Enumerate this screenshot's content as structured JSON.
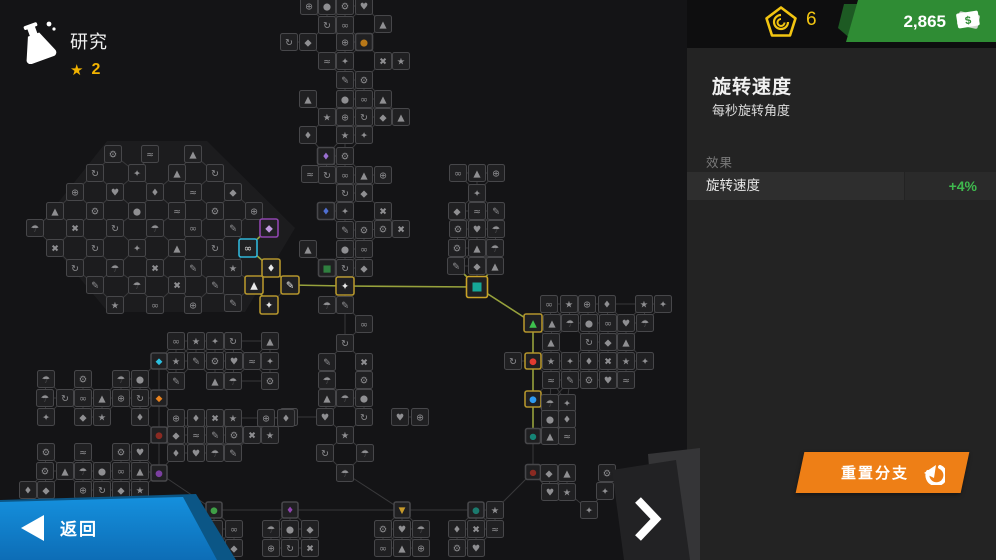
{
  "header": {
    "title": "研究",
    "star_icon": "★",
    "star_count": "2"
  },
  "currency": {
    "research_points": "6",
    "cash": "2,865",
    "cash_symbol": "$"
  },
  "panel": {
    "title": "旋转速度",
    "subtitle": "每秒旋转角度",
    "effects_label": "效果",
    "effect_row": {
      "name": "旋转速度",
      "value": "+4%"
    },
    "reset_label": "重置分支"
  },
  "nav": {
    "back_label": "返回"
  },
  "colors": {
    "accent_orange": "#ee7f16",
    "accent_blue": "#1287d6",
    "badge_green": "#2f8c34",
    "token_yellow": "#f2c511",
    "effect_green": "#3fb94e",
    "active_path": "#97a23c",
    "selected_teal": "#16a797"
  },
  "tree": {
    "plate": [
      [
        38,
        228
      ],
      [
        107,
        141
      ],
      [
        207,
        141
      ],
      [
        295,
        228
      ],
      [
        245,
        312
      ],
      [
        108,
        312
      ]
    ],
    "glyphs": "★♥◆⚙↻✎⊕≈▲✖∞♦●✦☂",
    "variants": {
      "n": {
        "s": 17,
        "b": "#47474a",
        "i": "#8f8f92"
      },
      "yb": {
        "s": 18,
        "b": "#b3942c",
        "i": "#e9e9e9"
      },
      "pb": {
        "s": 18,
        "b": "#8e44ad",
        "i": "#c09ae0"
      },
      "cb": {
        "s": 18,
        "b": "#2fb5d8",
        "i": "#e9e9e9"
      },
      "sel": {
        "s": 21,
        "b": "#c9a227",
        "i": "#16a797",
        "fill": true
      },
      "tri": {
        "s": 18,
        "b": "#b3942c",
        "i": "#3ec14e",
        "g": "▲"
      },
      "red": {
        "s": 16,
        "b": "#b3942c",
        "i": "#e23b30",
        "g": "●"
      },
      "blue": {
        "s": 16,
        "b": "#b3942c",
        "i": "#2f9bf0",
        "g": "●"
      },
      "teal2": {
        "s": 15,
        "b": "#47474a",
        "i": "#158576",
        "g": "●"
      },
      "dred": {
        "s": 15,
        "b": "#47474a",
        "i": "#8a2a22",
        "g": "●"
      },
      "cyan": {
        "s": 16,
        "b": "#47474a",
        "i": "#2cc0e0",
        "g": "◆"
      },
      "oflag": {
        "s": 16,
        "b": "#47474a",
        "i": "#e8821e",
        "g": "◆"
      },
      "maroon": {
        "s": 16,
        "b": "#47474a",
        "i": "#8a2a22",
        "g": "●"
      },
      "pur": {
        "s": 16,
        "b": "#47474a",
        "i": "#7b3fa0",
        "g": "●"
      },
      "grn": {
        "s": 16,
        "b": "#47474a",
        "i": "#3f9f46",
        "g": "●"
      },
      "pur2": {
        "s": 16,
        "b": "#47474a",
        "i": "#8e44ad",
        "g": "♦"
      },
      "atri": {
        "s": 16,
        "b": "#47474a",
        "i": "#c79a2a",
        "g": "▼"
      },
      "teal3": {
        "s": 16,
        "b": "#47474a",
        "i": "#1b7a6e",
        "g": "●"
      },
      "amber": {
        "s": 17,
        "b": "#47474a",
        "i": "#b87818",
        "g": "●"
      },
      "tp": {
        "s": 17,
        "b": "#47474a",
        "i": "#9a6fd0",
        "g": "♦"
      },
      "tb": {
        "s": 17,
        "b": "#47474a",
        "i": "#4f6fd0",
        "g": "♦"
      },
      "tg": {
        "s": 17,
        "b": "#47474a",
        "i": "#2f7f3f",
        "g": "■"
      }
    },
    "nodes": [
      [
        113,
        154
      ],
      [
        150,
        154
      ],
      [
        193,
        154
      ],
      [
        95,
        173
      ],
      [
        137,
        173
      ],
      [
        177,
        173
      ],
      [
        215,
        173
      ],
      [
        75,
        192
      ],
      [
        115,
        192
      ],
      [
        155,
        192
      ],
      [
        193,
        192
      ],
      [
        233,
        192
      ],
      [
        55,
        211
      ],
      [
        95,
        211
      ],
      [
        137,
        211
      ],
      [
        177,
        211
      ],
      [
        215,
        211
      ],
      [
        254,
        211
      ],
      [
        35,
        228
      ],
      [
        75,
        228
      ],
      [
        115,
        228
      ],
      [
        155,
        228
      ],
      [
        193,
        228
      ],
      [
        233,
        228
      ],
      [
        269,
        228,
        "pb"
      ],
      [
        55,
        248
      ],
      [
        95,
        248
      ],
      [
        137,
        248
      ],
      [
        177,
        248
      ],
      [
        215,
        248
      ],
      [
        248,
        248,
        "cb"
      ],
      [
        75,
        268
      ],
      [
        115,
        268
      ],
      [
        155,
        268
      ],
      [
        193,
        268
      ],
      [
        233,
        268
      ],
      [
        271,
        268,
        "yb"
      ],
      [
        95,
        285
      ],
      [
        137,
        285
      ],
      [
        177,
        285
      ],
      [
        215,
        285
      ],
      [
        254,
        285,
        "yb"
      ],
      [
        290,
        285,
        "yb"
      ],
      [
        115,
        305
      ],
      [
        155,
        305
      ],
      [
        193,
        305
      ],
      [
        233,
        303
      ],
      [
        269,
        305,
        "yb"
      ],
      [
        309,
        6
      ],
      [
        327,
        6
      ],
      [
        345,
        6
      ],
      [
        364,
        6
      ],
      [
        327,
        25
      ],
      [
        345,
        25
      ],
      [
        383,
        24
      ],
      [
        289,
        42
      ],
      [
        308,
        42
      ],
      [
        345,
        42
      ],
      [
        364,
        42,
        "amber"
      ],
      [
        327,
        61
      ],
      [
        345,
        61
      ],
      [
        383,
        61
      ],
      [
        401,
        61
      ],
      [
        345,
        80
      ],
      [
        364,
        80
      ],
      [
        308,
        99
      ],
      [
        345,
        99
      ],
      [
        364,
        99
      ],
      [
        383,
        99
      ],
      [
        327,
        117
      ],
      [
        345,
        117
      ],
      [
        364,
        117
      ],
      [
        383,
        117
      ],
      [
        401,
        117
      ],
      [
        308,
        135
      ],
      [
        345,
        135
      ],
      [
        364,
        135
      ],
      [
        326,
        156,
        "tp"
      ],
      [
        345,
        156
      ],
      [
        310,
        174
      ],
      [
        327,
        175
      ],
      [
        345,
        175
      ],
      [
        364,
        175
      ],
      [
        383,
        175
      ],
      [
        345,
        193
      ],
      [
        364,
        193
      ],
      [
        326,
        211,
        "tb"
      ],
      [
        345,
        211
      ],
      [
        383,
        211
      ],
      [
        345,
        230
      ],
      [
        364,
        230
      ],
      [
        383,
        229
      ],
      [
        401,
        229
      ],
      [
        308,
        249
      ],
      [
        345,
        249
      ],
      [
        364,
        249
      ],
      [
        327,
        268,
        "tg"
      ],
      [
        345,
        268
      ],
      [
        364,
        268
      ],
      [
        345,
        286,
        "yb"
      ],
      [
        327,
        305
      ],
      [
        345,
        305
      ],
      [
        364,
        324
      ],
      [
        345,
        343
      ],
      [
        327,
        362
      ],
      [
        364,
        362
      ],
      [
        327,
        380
      ],
      [
        364,
        380
      ],
      [
        327,
        398
      ],
      [
        345,
        398
      ],
      [
        364,
        398
      ],
      [
        289,
        417
      ],
      [
        325,
        417
      ],
      [
        364,
        417
      ],
      [
        400,
        417
      ],
      [
        420,
        417
      ],
      [
        345,
        435
      ],
      [
        325,
        453
      ],
      [
        365,
        453
      ],
      [
        345,
        473
      ],
      [
        458,
        173
      ],
      [
        477,
        173
      ],
      [
        496,
        173
      ],
      [
        477,
        193
      ],
      [
        457,
        211
      ],
      [
        477,
        211
      ],
      [
        496,
        211
      ],
      [
        458,
        229
      ],
      [
        477,
        229
      ],
      [
        496,
        229
      ],
      [
        457,
        248
      ],
      [
        477,
        248
      ],
      [
        495,
        248
      ],
      [
        456,
        266
      ],
      [
        477,
        266
      ],
      [
        495,
        266
      ],
      [
        477,
        287,
        "sel"
      ],
      [
        533,
        323,
        "tri"
      ],
      [
        533,
        361,
        "red"
      ],
      [
        533,
        399,
        "blue"
      ],
      [
        533,
        436,
        "teal2"
      ],
      [
        533,
        472,
        "dred"
      ],
      [
        549,
        304
      ],
      [
        569,
        304
      ],
      [
        587,
        304
      ],
      [
        607,
        304
      ],
      [
        644,
        304
      ],
      [
        663,
        304
      ],
      [
        552,
        323
      ],
      [
        570,
        323
      ],
      [
        589,
        323
      ],
      [
        608,
        323
      ],
      [
        626,
        323
      ],
      [
        645,
        323
      ],
      [
        551,
        342
      ],
      [
        589,
        342
      ],
      [
        608,
        342
      ],
      [
        626,
        342
      ],
      [
        513,
        361
      ],
      [
        551,
        361
      ],
      [
        570,
        361
      ],
      [
        589,
        361
      ],
      [
        608,
        361
      ],
      [
        626,
        361
      ],
      [
        645,
        361
      ],
      [
        551,
        380
      ],
      [
        570,
        380
      ],
      [
        589,
        380
      ],
      [
        608,
        380
      ],
      [
        626,
        380
      ],
      [
        550,
        403
      ],
      [
        567,
        403
      ],
      [
        550,
        419
      ],
      [
        567,
        419
      ],
      [
        550,
        436
      ],
      [
        567,
        436
      ],
      [
        549,
        473
      ],
      [
        567,
        473
      ],
      [
        550,
        492
      ],
      [
        567,
        492
      ],
      [
        607,
        473
      ],
      [
        605,
        491
      ],
      [
        589,
        510
      ],
      [
        159,
        361,
        "cyan"
      ],
      [
        159,
        398,
        "oflag"
      ],
      [
        159,
        435,
        "maroon"
      ],
      [
        159,
        473,
        "pur"
      ],
      [
        176,
        341
      ],
      [
        196,
        341
      ],
      [
        215,
        341
      ],
      [
        233,
        341
      ],
      [
        270,
        341
      ],
      [
        176,
        361
      ],
      [
        196,
        361
      ],
      [
        215,
        361
      ],
      [
        234,
        361
      ],
      [
        252,
        361
      ],
      [
        270,
        361
      ],
      [
        176,
        381
      ],
      [
        215,
        381
      ],
      [
        233,
        381
      ],
      [
        270,
        381
      ],
      [
        176,
        418
      ],
      [
        196,
        418
      ],
      [
        215,
        418
      ],
      [
        233,
        418
      ],
      [
        266,
        418
      ],
      [
        286,
        418
      ],
      [
        176,
        435
      ],
      [
        196,
        435
      ],
      [
        215,
        435
      ],
      [
        234,
        435
      ],
      [
        252,
        435
      ],
      [
        270,
        435
      ],
      [
        176,
        453
      ],
      [
        196,
        453
      ],
      [
        215,
        453
      ],
      [
        233,
        453
      ],
      [
        46,
        379
      ],
      [
        83,
        379
      ],
      [
        121,
        379
      ],
      [
        140,
        379
      ],
      [
        45,
        398
      ],
      [
        65,
        398
      ],
      [
        83,
        398
      ],
      [
        102,
        398
      ],
      [
        121,
        398
      ],
      [
        140,
        398
      ],
      [
        46,
        417
      ],
      [
        83,
        417
      ],
      [
        102,
        417
      ],
      [
        140,
        417
      ],
      [
        46,
        452
      ],
      [
        83,
        452
      ],
      [
        121,
        452
      ],
      [
        140,
        452
      ],
      [
        45,
        471
      ],
      [
        65,
        471
      ],
      [
        83,
        471
      ],
      [
        102,
        471
      ],
      [
        121,
        471
      ],
      [
        140,
        471
      ],
      [
        28,
        490
      ],
      [
        46,
        490
      ],
      [
        83,
        490
      ],
      [
        102,
        490
      ],
      [
        121,
        490
      ],
      [
        140,
        490
      ],
      [
        214,
        510,
        "grn"
      ],
      [
        290,
        510,
        "pur2"
      ],
      [
        402,
        510,
        "atri"
      ],
      [
        476,
        510,
        "teal3"
      ],
      [
        495,
        510
      ],
      [
        214,
        529
      ],
      [
        234,
        529
      ],
      [
        214,
        548
      ],
      [
        234,
        548
      ],
      [
        271,
        529
      ],
      [
        290,
        529
      ],
      [
        310,
        529
      ],
      [
        271,
        548
      ],
      [
        290,
        548
      ],
      [
        310,
        548
      ],
      [
        383,
        529
      ],
      [
        402,
        529
      ],
      [
        421,
        529
      ],
      [
        383,
        548
      ],
      [
        402,
        548
      ],
      [
        421,
        548
      ],
      [
        457,
        529
      ],
      [
        476,
        529
      ],
      [
        495,
        529
      ],
      [
        457,
        548
      ],
      [
        476,
        548
      ]
    ],
    "edges": [
      [
        269,
        228,
        248,
        248,
        1
      ],
      [
        248,
        248,
        271,
        268,
        1
      ],
      [
        271,
        268,
        290,
        285,
        1
      ],
      [
        254,
        285,
        269,
        305,
        1
      ],
      [
        290,
        285,
        345,
        286,
        1
      ],
      [
        345,
        286,
        477,
        287,
        1
      ],
      [
        477,
        287,
        533,
        323,
        1
      ],
      [
        533,
        323,
        533,
        361,
        1
      ],
      [
        533,
        361,
        533,
        399,
        1
      ],
      [
        533,
        399,
        533,
        436,
        1
      ],
      [
        456,
        266,
        477,
        287,
        1
      ],
      [
        495,
        266,
        477,
        287,
        1
      ],
      [
        533,
        436,
        533,
        472,
        0
      ],
      [
        533,
        472,
        495,
        510,
        0
      ],
      [
        159,
        361,
        159,
        398,
        0
      ],
      [
        159,
        398,
        159,
        435,
        0
      ],
      [
        159,
        435,
        159,
        473,
        0
      ],
      [
        159,
        473,
        214,
        510,
        0
      ],
      [
        214,
        510,
        290,
        510,
        0
      ],
      [
        290,
        510,
        402,
        510,
        0
      ],
      [
        402,
        510,
        476,
        510,
        0
      ],
      [
        345,
        473,
        402,
        510,
        0
      ],
      [
        345,
        305,
        345,
        343,
        0
      ],
      [
        289,
        417,
        325,
        417,
        0
      ],
      [
        233,
        341,
        270,
        341,
        0
      ],
      [
        233,
        381,
        270,
        381,
        0
      ],
      [
        233,
        418,
        266,
        418,
        0
      ],
      [
        607,
        304,
        644,
        304,
        0
      ]
    ]
  }
}
